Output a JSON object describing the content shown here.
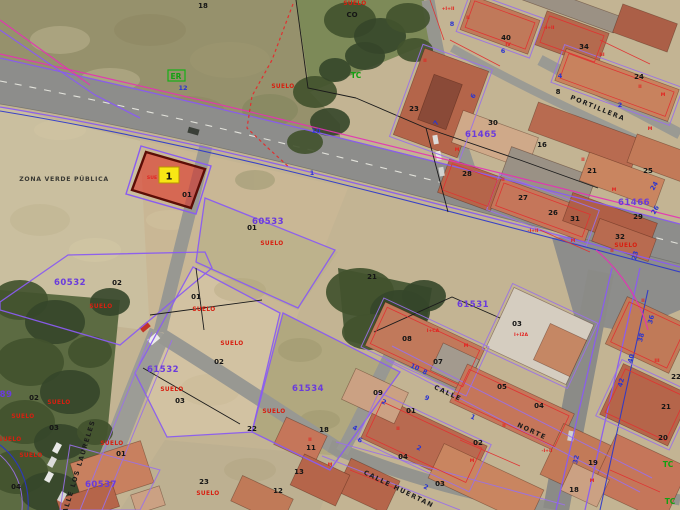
{
  "map": {
    "type": "cadastral-aerial-view",
    "description": "Aerial orthophoto with cadastral parcel overlay and one highlighted plot",
    "highlight": {
      "marker_number": "1",
      "parcel_label": "01",
      "land_use_partial": "SUE",
      "fill_color": "#e0281e",
      "marker_color": "#f8e714"
    },
    "colors": {
      "parcel_line": "#8a5cf0",
      "road_line_magenta": "#e531b5",
      "road_line_blue": "#2a35cc",
      "building_line_red": "#e03030",
      "boundary_black": "#1b1b1b",
      "green_marks": "#12a112"
    }
  },
  "map_labels": [
    {
      "t": "18",
      "x": 203,
      "y": 8,
      "k": "black"
    },
    {
      "t": "CO",
      "x": 352,
      "y": 17,
      "k": "black",
      "s": 5
    },
    {
      "t": "SUELO",
      "x": 355,
      "y": 5,
      "k": "red"
    },
    {
      "t": "ER",
      "x": 176,
      "y": 79,
      "k": "green",
      "s": 7
    },
    {
      "t": "12",
      "x": 183,
      "y": 90,
      "k": "blue"
    },
    {
      "t": "TC",
      "x": 356,
      "y": 78,
      "k": "green"
    },
    {
      "t": "SUELO",
      "x": 283,
      "y": 88,
      "k": "red",
      "s": 5
    },
    {
      "t": "10",
      "x": 316,
      "y": 133,
      "k": "blue"
    },
    {
      "t": "1",
      "x": 312,
      "y": 175,
      "k": "blue"
    },
    {
      "t": "ZONA VERDE PÚBLICA",
      "x": 64,
      "y": 181,
      "k": "zone"
    },
    {
      "t": "SUE",
      "x": 152,
      "y": 179,
      "k": "code",
      "s": 5
    },
    {
      "t": "01",
      "x": 187,
      "y": 197,
      "k": "black"
    },
    {
      "t": "60533",
      "x": 268,
      "y": 224,
      "k": "purple"
    },
    {
      "t": "01",
      "x": 252,
      "y": 230,
      "k": "black"
    },
    {
      "t": "SUELO",
      "x": 272,
      "y": 245,
      "k": "red"
    },
    {
      "t": "60532",
      "x": 70,
      "y": 285,
      "k": "purple"
    },
    {
      "t": "02",
      "x": 117,
      "y": 285,
      "k": "black"
    },
    {
      "t": "SUELO",
      "x": 101,
      "y": 308,
      "k": "red"
    },
    {
      "t": "01",
      "x": 196,
      "y": 299,
      "k": "black"
    },
    {
      "t": "SUELO",
      "x": 204,
      "y": 311,
      "k": "red"
    },
    {
      "t": "SUELO",
      "x": 232,
      "y": 345,
      "k": "red"
    },
    {
      "t": "02",
      "x": 219,
      "y": 364,
      "k": "black"
    },
    {
      "t": "61532",
      "x": 163,
      "y": 372,
      "k": "purple"
    },
    {
      "t": "SUELO",
      "x": 172,
      "y": 391,
      "k": "red"
    },
    {
      "t": "03",
      "x": 180,
      "y": 403,
      "k": "black"
    },
    {
      "t": "22",
      "x": 252,
      "y": 431,
      "k": "black"
    },
    {
      "t": "61534",
      "x": 308,
      "y": 391,
      "k": "purple"
    },
    {
      "t": "SUELO",
      "x": 274,
      "y": 413,
      "k": "red"
    },
    {
      "t": "89",
      "x": 6,
      "y": 397,
      "k": "purple",
      "s": 7.5
    },
    {
      "t": "02",
      "x": 34,
      "y": 400,
      "k": "black"
    },
    {
      "t": "SUELO",
      "x": 59,
      "y": 404,
      "k": "red",
      "s": 5
    },
    {
      "t": "SUELO",
      "x": 23,
      "y": 418,
      "k": "red",
      "s": 5
    },
    {
      "t": "03",
      "x": 54,
      "y": 430,
      "k": "black"
    },
    {
      "t": "SUELO",
      "x": 10,
      "y": 441,
      "k": "red",
      "s": 5
    },
    {
      "t": "SUELO",
      "x": 31,
      "y": 457,
      "k": "red",
      "s": 5
    },
    {
      "t": "04",
      "x": 16,
      "y": 489,
      "k": "black"
    },
    {
      "t": "CALLE LOS LAURELES",
      "x": 80,
      "y": 470,
      "k": "street",
      "r": -73,
      "s": 6
    },
    {
      "t": "SUELO",
      "x": 112,
      "y": 445,
      "k": "red",
      "s": 5
    },
    {
      "t": "01",
      "x": 121,
      "y": 456,
      "k": "black"
    },
    {
      "t": "60537",
      "x": 101,
      "y": 487,
      "k": "purple"
    },
    {
      "t": "23",
      "x": 204,
      "y": 484,
      "k": "black"
    },
    {
      "t": "SUELO",
      "x": 208,
      "y": 495,
      "k": "red"
    },
    {
      "t": "18",
      "x": 324,
      "y": 432,
      "k": "black"
    },
    {
      "t": "11",
      "x": 311,
      "y": 450,
      "k": "black"
    },
    {
      "t": "13",
      "x": 299,
      "y": 474,
      "k": "black"
    },
    {
      "t": "12",
      "x": 278,
      "y": 493,
      "k": "black"
    },
    {
      "t": "40",
      "x": 506,
      "y": 40,
      "k": "black"
    },
    {
      "t": "34",
      "x": 584,
      "y": 49,
      "k": "black"
    },
    {
      "t": "24",
      "x": 639,
      "y": 79,
      "k": "black"
    },
    {
      "t": "8",
      "x": 558,
      "y": 94,
      "k": "black",
      "s": 6
    },
    {
      "t": "PORTILLERA",
      "x": 597,
      "y": 110,
      "k": "street",
      "r": 22,
      "s": 7.5
    },
    {
      "t": "23",
      "x": 414,
      "y": 111,
      "k": "black"
    },
    {
      "t": "30",
      "x": 493,
      "y": 125,
      "k": "black"
    },
    {
      "t": "61465",
      "x": 481,
      "y": 137,
      "k": "purple",
      "s": 7.5
    },
    {
      "t": "16",
      "x": 542,
      "y": 147,
      "k": "black"
    },
    {
      "t": "28",
      "x": 467,
      "y": 176,
      "k": "black"
    },
    {
      "t": "21",
      "x": 592,
      "y": 173,
      "k": "black"
    },
    {
      "t": "25",
      "x": 648,
      "y": 173,
      "k": "black"
    },
    {
      "t": "27",
      "x": 523,
      "y": 200,
      "k": "black"
    },
    {
      "t": "26",
      "x": 553,
      "y": 215,
      "k": "black"
    },
    {
      "t": "31",
      "x": 575,
      "y": 221,
      "k": "black"
    },
    {
      "t": "61466",
      "x": 634,
      "y": 205,
      "k": "purple",
      "s": 7.5
    },
    {
      "t": "29",
      "x": 638,
      "y": 219,
      "k": "black"
    },
    {
      "t": "32",
      "x": 620,
      "y": 239,
      "k": "black"
    },
    {
      "t": "SUELO",
      "x": 626,
      "y": 247,
      "k": "red",
      "s": 5
    },
    {
      "t": "8",
      "x": 452,
      "y": 26,
      "k": "blue"
    },
    {
      "t": "6",
      "x": 503,
      "y": 53,
      "k": "blue"
    },
    {
      "t": "4",
      "x": 560,
      "y": 78,
      "k": "blue"
    },
    {
      "t": "2",
      "x": 620,
      "y": 107,
      "k": "blue"
    },
    {
      "t": "7",
      "x": 438,
      "y": 124,
      "k": "blue",
      "r": -60
    },
    {
      "t": "6",
      "x": 475,
      "y": 97,
      "k": "blue",
      "r": -60
    },
    {
      "t": "24",
      "x": 656,
      "y": 187,
      "k": "blue",
      "r": -60,
      "s": 5.5
    },
    {
      "t": "26",
      "x": 657,
      "y": 211,
      "k": "blue",
      "r": -60,
      "s": 5.5
    },
    {
      "t": "23",
      "x": 637,
      "y": 256,
      "k": "blue",
      "r": -75,
      "s": 5.5
    },
    {
      "t": "36",
      "x": 653,
      "y": 320,
      "k": "blue",
      "r": -75,
      "s": 5.5
    },
    {
      "t": "38",
      "x": 643,
      "y": 338,
      "k": "blue",
      "r": -75,
      "s": 5.5
    },
    {
      "t": "40",
      "x": 633,
      "y": 359,
      "k": "blue",
      "r": -75,
      "s": 5.5
    },
    {
      "t": "42",
      "x": 623,
      "y": 383,
      "k": "blue",
      "r": -75,
      "s": 5.5
    },
    {
      "t": "61531",
      "x": 473,
      "y": 307,
      "k": "purple"
    },
    {
      "t": "03",
      "x": 517,
      "y": 326,
      "k": "black"
    },
    {
      "t": "I+I2A",
      "x": 521,
      "y": 336,
      "k": "code"
    },
    {
      "t": "21",
      "x": 372,
      "y": 279,
      "k": "black"
    },
    {
      "t": "08",
      "x": 407,
      "y": 341,
      "k": "black"
    },
    {
      "t": "07",
      "x": 438,
      "y": 364,
      "k": "black"
    },
    {
      "t": "09",
      "x": 378,
      "y": 395,
      "k": "black"
    },
    {
      "t": "10",
      "x": 414,
      "y": 369,
      "k": "blue",
      "r": 25,
      "s": 5.5
    },
    {
      "t": "8",
      "x": 424,
      "y": 374,
      "k": "blue",
      "r": 25,
      "s": 5.5
    },
    {
      "t": "9",
      "x": 426,
      "y": 400,
      "k": "blue",
      "r": 25,
      "s": 5.5
    },
    {
      "t": "2",
      "x": 383,
      "y": 404,
      "k": "blue",
      "r": 25,
      "s": 5.5
    },
    {
      "t": "CALLE",
      "x": 447,
      "y": 395,
      "k": "street",
      "r": 25
    },
    {
      "t": "NORTE",
      "x": 531,
      "y": 433,
      "k": "street",
      "r": 25
    },
    {
      "t": "05",
      "x": 502,
      "y": 389,
      "k": "black"
    },
    {
      "t": "04",
      "x": 539,
      "y": 408,
      "k": "black"
    },
    {
      "t": "01",
      "x": 411,
      "y": 413,
      "k": "black"
    },
    {
      "t": "02",
      "x": 478,
      "y": 445,
      "k": "black"
    },
    {
      "t": "04",
      "x": 403,
      "y": 459,
      "k": "black"
    },
    {
      "t": "1",
      "x": 472,
      "y": 419,
      "k": "blue",
      "r": 25,
      "s": 5.5
    },
    {
      "t": "4",
      "x": 354,
      "y": 430,
      "k": "blue",
      "r": 25,
      "s": 5.5
    },
    {
      "t": "6",
      "x": 359,
      "y": 442,
      "k": "blue",
      "r": 25,
      "s": 5.5
    },
    {
      "t": "2",
      "x": 418,
      "y": 450,
      "k": "blue",
      "r": 25,
      "s": 5.5
    },
    {
      "t": "03",
      "x": 440,
      "y": 486,
      "k": "black"
    },
    {
      "t": "2",
      "x": 425,
      "y": 489,
      "k": "blue",
      "r": 25,
      "s": 5.5
    },
    {
      "t": "CALLE HUERTAN",
      "x": 398,
      "y": 491,
      "k": "street",
      "r": 26,
      "s": 6
    },
    {
      "t": "19",
      "x": 593,
      "y": 465,
      "k": "black"
    },
    {
      "t": "18",
      "x": 574,
      "y": 492,
      "k": "black"
    },
    {
      "t": "32",
      "x": 578,
      "y": 460,
      "k": "blue",
      "r": -75,
      "s": 5.5
    },
    {
      "t": "20",
      "x": 663,
      "y": 440,
      "k": "black"
    },
    {
      "t": "21",
      "x": 666,
      "y": 409,
      "k": "black"
    },
    {
      "t": "22",
      "x": 676,
      "y": 379,
      "k": "black"
    },
    {
      "t": "TC",
      "x": 668,
      "y": 467,
      "k": "green"
    },
    {
      "t": "TC",
      "x": 670,
      "y": 504,
      "k": "green"
    },
    {
      "t": "+I+II",
      "x": 448,
      "y": 10,
      "k": "code"
    },
    {
      "t": "II",
      "x": 468,
      "y": 19,
      "k": "code"
    },
    {
      "t": "IV",
      "x": 508,
      "y": 46,
      "k": "code"
    },
    {
      "t": "-I+II",
      "x": 549,
      "y": 29,
      "k": "code"
    },
    {
      "t": "III",
      "x": 602,
      "y": 56,
      "k": "code"
    },
    {
      "t": "II",
      "x": 640,
      "y": 88,
      "k": "code"
    },
    {
      "t": "M",
      "x": 663,
      "y": 96,
      "k": "code"
    },
    {
      "t": "II",
      "x": 425,
      "y": 62,
      "k": "code"
    },
    {
      "t": "M",
      "x": 457,
      "y": 151,
      "k": "code"
    },
    {
      "t": "II",
      "x": 503,
      "y": 181,
      "k": "code"
    },
    {
      "t": "-I+II",
      "x": 533,
      "y": 232,
      "k": "code"
    },
    {
      "t": "M",
      "x": 573,
      "y": 242,
      "k": "code"
    },
    {
      "t": "II",
      "x": 612,
      "y": 252,
      "k": "code"
    },
    {
      "t": "M",
      "x": 650,
      "y": 130,
      "k": "code"
    },
    {
      "t": "II",
      "x": 583,
      "y": 161,
      "k": "code"
    },
    {
      "t": "M",
      "x": 614,
      "y": 191,
      "k": "code"
    },
    {
      "t": "I+CA",
      "x": 433,
      "y": 332,
      "k": "code"
    },
    {
      "t": "M",
      "x": 466,
      "y": 347,
      "k": "code"
    },
    {
      "t": "II",
      "x": 504,
      "y": 427,
      "k": "code"
    },
    {
      "t": "-I+II",
      "x": 547,
      "y": 452,
      "k": "code"
    },
    {
      "t": "M",
      "x": 472,
      "y": 462,
      "k": "code"
    },
    {
      "t": "II",
      "x": 398,
      "y": 430,
      "k": "code"
    },
    {
      "t": "M",
      "x": 592,
      "y": 482,
      "k": "code"
    },
    {
      "t": "II",
      "x": 643,
      "y": 302,
      "k": "code"
    },
    {
      "t": "III",
      "x": 657,
      "y": 362,
      "k": "code"
    },
    {
      "t": "II",
      "x": 310,
      "y": 441,
      "k": "code"
    },
    {
      "t": "M",
      "x": 330,
      "y": 466,
      "k": "code"
    }
  ]
}
